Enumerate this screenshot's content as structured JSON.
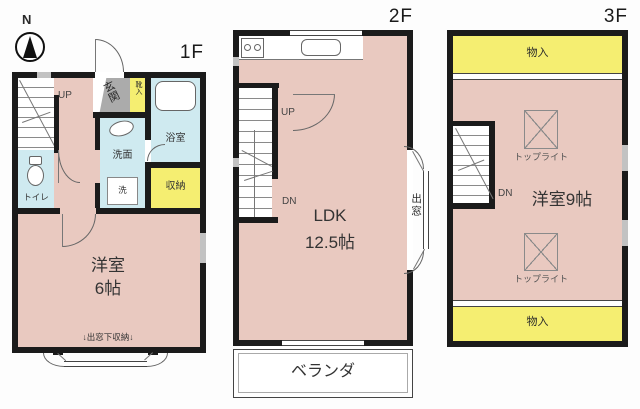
{
  "compass": {
    "north_label": "N"
  },
  "floor1": {
    "label": "1F",
    "stairs_up": "UP",
    "toilet": "トイレ",
    "entrance": "玄関",
    "shoe_cabinet": "靴入",
    "bathroom": "浴室",
    "washroom": "洗面",
    "washer": "洗",
    "closet": "収納",
    "bedroom_name": "洋室",
    "bedroom_size": "6帖",
    "bay_window_note": "↓出窓下収納↓"
  },
  "floor2": {
    "label": "2F",
    "stairs_up": "UP",
    "stairs_down": "DN",
    "ldk_name": "LDK",
    "ldk_size": "12.5帖",
    "bay_window": "出窓",
    "veranda": "ベランダ"
  },
  "floor3": {
    "label": "3F",
    "stairs_down": "DN",
    "closet_top": "物入",
    "room": "洋室9帖",
    "skylight_top": "トップライト",
    "skylight_bottom": "トップライト",
    "closet_bottom": "物入"
  },
  "colors": {
    "room_pink": "#e9c9c0",
    "wet_area_blue": "#cfeaf0",
    "storage_yellow": "#f5ee71",
    "entrance_gray": "#ababab",
    "wall_black": "#1b1b1b"
  }
}
